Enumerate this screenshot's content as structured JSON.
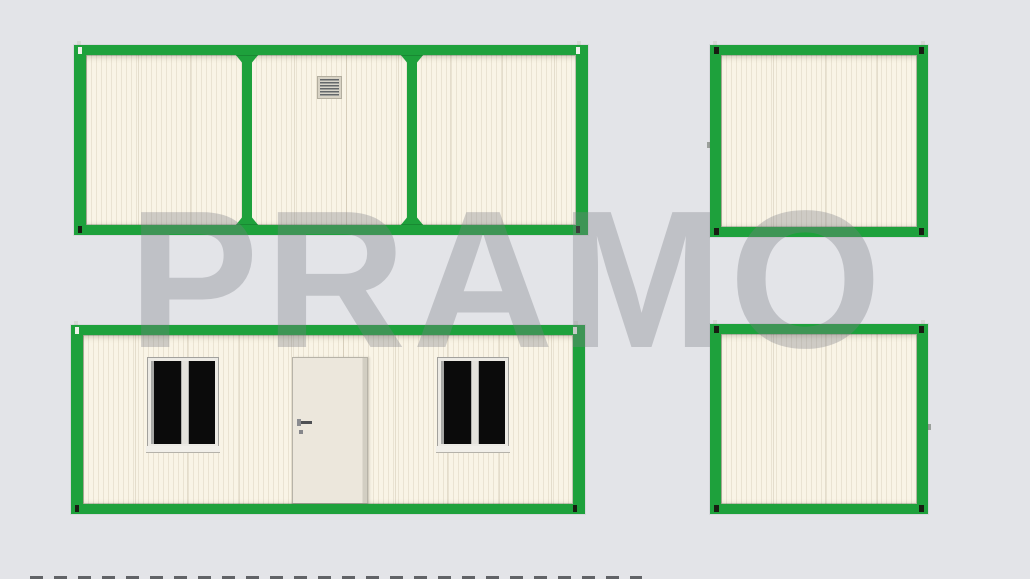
{
  "watermark": {
    "text": "PRAMO",
    "color": "#7d7f87"
  },
  "palette": {
    "background": "#e3e4e8",
    "frame_green": "#1ea13c",
    "wall_cream": "#f9f4e6",
    "door_beige": "#ece7dc",
    "window_pane": "#0b0b0b",
    "window_frame": "#eceae4",
    "fitting_dark": "#181d12",
    "fitting_light": "#eef2ea",
    "watermark": "#7d7f87"
  },
  "views": {
    "rear_elevation": {
      "panels": 3,
      "vent_grilles": 1
    },
    "front_elevation": {
      "windows": 2,
      "doors": 1
    },
    "end_elevation_top": {
      "panels": 1
    },
    "end_elevation_bottom": {
      "panels": 1
    }
  }
}
